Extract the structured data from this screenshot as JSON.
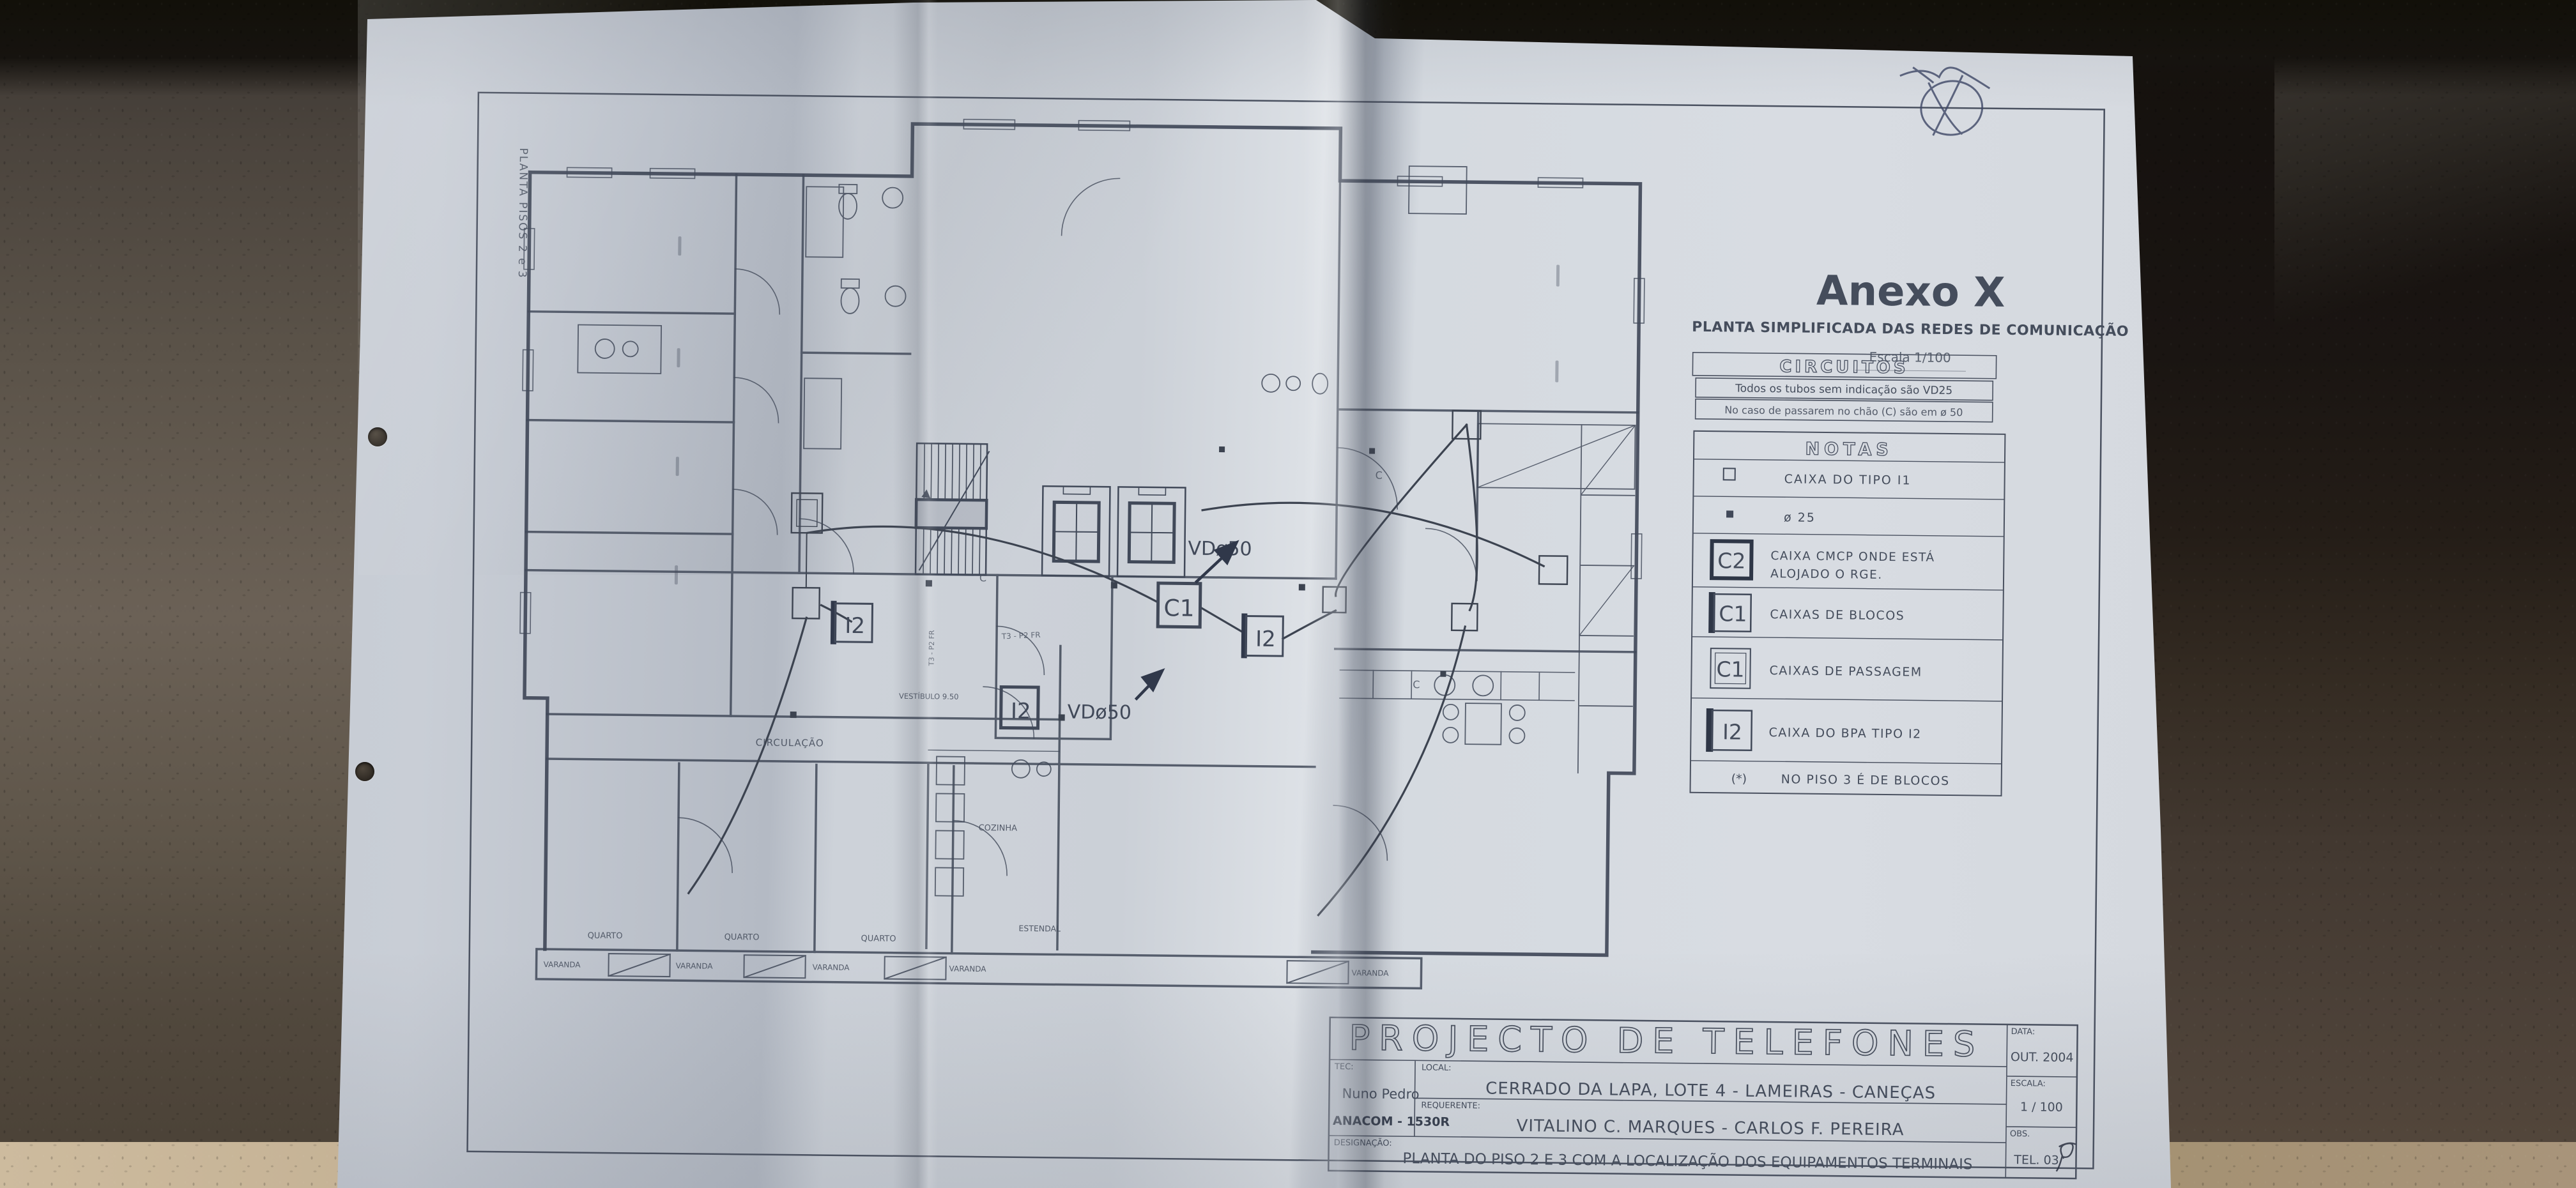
{
  "colors": {
    "paper": "#ccd1d8",
    "ink": "#454d5c",
    "leather_dark": "#1d1915",
    "leather_brown": "#4a4038",
    "leather_gray": "#5d564c",
    "table_tan": "#b5a186",
    "pen_ink": "#3e4766"
  },
  "side_label": "PLANTA PISOS 2 e 3",
  "header": {
    "title": "Anexo X",
    "subtitle": "PLANTA SIMPLIFICADA DAS REDES DE COMUNICAÇÃO",
    "scale": "Escala 1/100"
  },
  "circuitos": {
    "title": "CIRCUITOS",
    "line1": "Todos os tubos sem indicação são VD25",
    "line2": "No caso de passarem no chão (C) são em ø 50"
  },
  "notas": {
    "title": "NOTAS",
    "row1": {
      "text": "CAIXA DO TIPO I1"
    },
    "row2": {
      "text": "ø 25"
    },
    "row3": {
      "code": "C2",
      "text1": "CAIXA CMCP ONDE ESTÁ",
      "text2": "ALOJADO O RGE."
    },
    "row4": {
      "code": "C1",
      "text": "CAIXAS DE BLOCOS"
    },
    "row5": {
      "code": "C1",
      "text": "CAIXAS DE PASSAGEM"
    },
    "row6": {
      "code": "I2",
      "text": "CAIXA DO BPA TIPO I2"
    },
    "footnote": {
      "symbol": "(*)",
      "text": "NO PISO 3 É DE BLOCOS"
    }
  },
  "titleblock": {
    "title": "PROJECTO DE TELEFONES",
    "tec_label": "TEC:",
    "tec_value": "Nuno Pedro",
    "tec_stamp": "ANACOM - 1530R",
    "local_label": "LOCAL:",
    "local_value": "CERRADO DA LAPA, LOTE 4 - LAMEIRAS - CANEÇAS",
    "requerente_label": "REQUERENTE:",
    "requerente_value": "VITALINO C. MARQUES - CARLOS F. PEREIRA",
    "designacao_label": "DESIGNAÇÃO:",
    "designacao_value": "PLANTA DO PISO 2 E 3 COM A LOCALIZAÇÃO DOS EQUIPAMENTOS TERMINAIS",
    "data_label": "DATA:",
    "data_value": "OUT. 2004",
    "escala_label": "ESCALA:",
    "escala_value": "1 / 100",
    "obs_label": "OBS.",
    "obs_value": "TEL. 03"
  },
  "plan": {
    "duct_label_top": "VDø50",
    "duct_label_bottom": "VDø50",
    "box_c1": "C1",
    "box_i2_left": "I2",
    "box_i2_right": "I2",
    "box_i2_bottom": "I2",
    "rooms": {
      "circulacao": "CIRCULAÇÃO",
      "vestibulo": "VESTÍBULO 9.50",
      "cozinha": "COZINHA",
      "estendal": "ESTENDAL",
      "quartos": [
        "QUARTO",
        "QUARTO",
        "QUARTO"
      ],
      "varandas": [
        "VARANDA",
        "VARANDA",
        "VARANDA",
        "VARANDA",
        "VARANDA"
      ]
    },
    "cable_marks": [
      "C",
      "C",
      "C"
    ],
    "micro_labels": [
      "T3 - P2 FR",
      "T3 - P2 FR"
    ]
  }
}
